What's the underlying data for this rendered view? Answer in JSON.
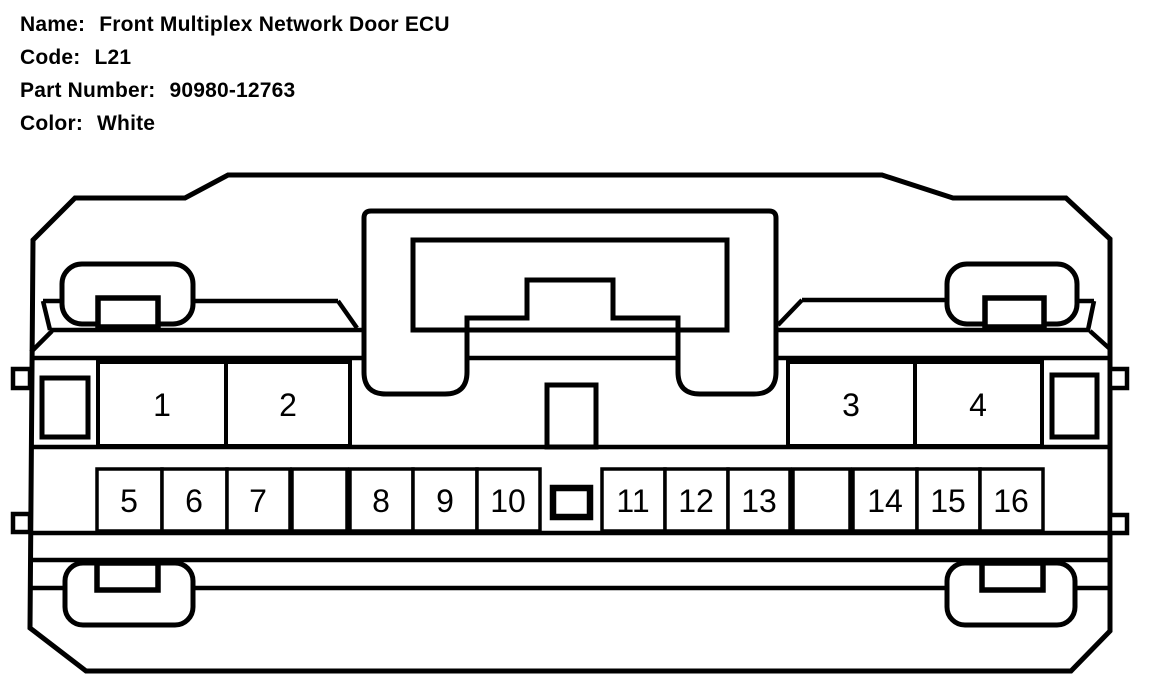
{
  "header": {
    "rows": [
      {
        "label": "Name:",
        "value": "Front Multiplex Network Door ECU"
      },
      {
        "label": "Code:",
        "value": "L21"
      },
      {
        "label": "Part Number:",
        "value": "90980-12763"
      },
      {
        "label": "Color:",
        "value": "White"
      }
    ]
  },
  "connector": {
    "pins_upper": [
      "1",
      "2",
      "3",
      "4"
    ],
    "pins_lower": [
      "5",
      "6",
      "7",
      "8",
      "9",
      "10",
      "11",
      "12",
      "13",
      "14",
      "15",
      "16"
    ],
    "line_color": "#000000",
    "background_color": "#ffffff"
  }
}
